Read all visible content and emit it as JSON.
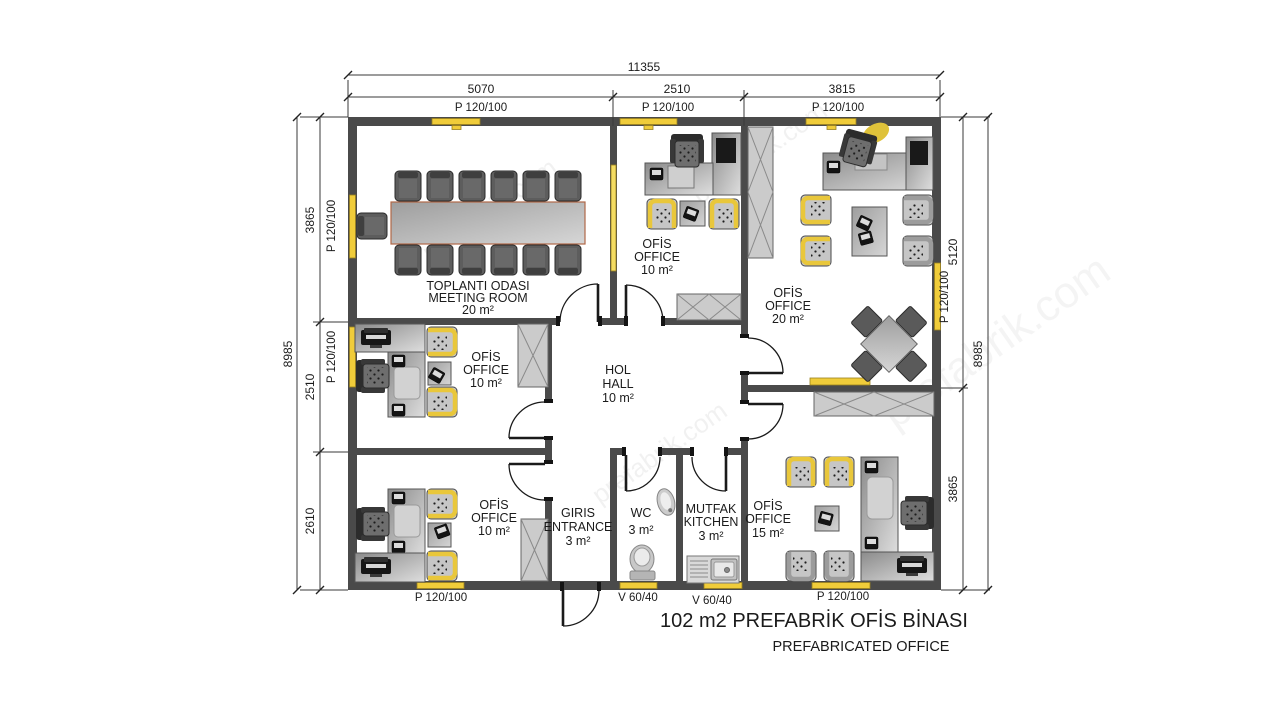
{
  "title": {
    "main": "102 m2 PREFABRİK OFİS BİNASI",
    "sub": "PREFABRICATED OFFICE"
  },
  "watermark": "prefabrik.com",
  "dims": {
    "top_total": "11355",
    "top_seg_1": "5070",
    "top_seg_2": "2510",
    "top_seg_3": "3815",
    "left_total": "8985",
    "left_seg_1": "3865",
    "left_seg_2": "2510",
    "left_seg_3": "2610",
    "right_total": "8985",
    "right_seg_1": "5120",
    "right_seg_2": "3865"
  },
  "openings": {
    "window_door_label": "P 120/100",
    "vent_label": "V 60/40"
  },
  "rooms": {
    "meeting": {
      "name_tr": "TOPLANTI ODASI",
      "name_en": "MEETING ROOM",
      "area": "20 m²"
    },
    "office_top": {
      "name_tr": "OFİS",
      "name_en": "OFFICE",
      "area": "10 m²"
    },
    "office_right": {
      "name_tr": "OFİS",
      "name_en": "OFFICE",
      "area": "20 m²"
    },
    "office_mid_left": {
      "name_tr": "OFİS",
      "name_en": "OFFICE",
      "area": "10 m²"
    },
    "hall": {
      "name_tr": "HOL",
      "name_en": "HALL",
      "area": "10 m²"
    },
    "office_bottom_left": {
      "name_tr": "OFİS",
      "name_en": "OFFICE",
      "area": "10 m²"
    },
    "entrance": {
      "name_tr": "GIRIS",
      "name_en": "ENTRANCE",
      "area": "3 m²"
    },
    "wc": {
      "name_tr": "WC",
      "area": "3 m²"
    },
    "kitchen": {
      "name_tr": "MUTFAK",
      "name_en": "KITCHEN",
      "area": "3 m²"
    },
    "office_bottom_right": {
      "name_tr": "OFİS",
      "name_en": "OFFICE",
      "area": "15 m²"
    }
  },
  "colors": {
    "wall": "#4a4a4a",
    "window": "#f0cc3a",
    "floor": "#ffffff"
  }
}
